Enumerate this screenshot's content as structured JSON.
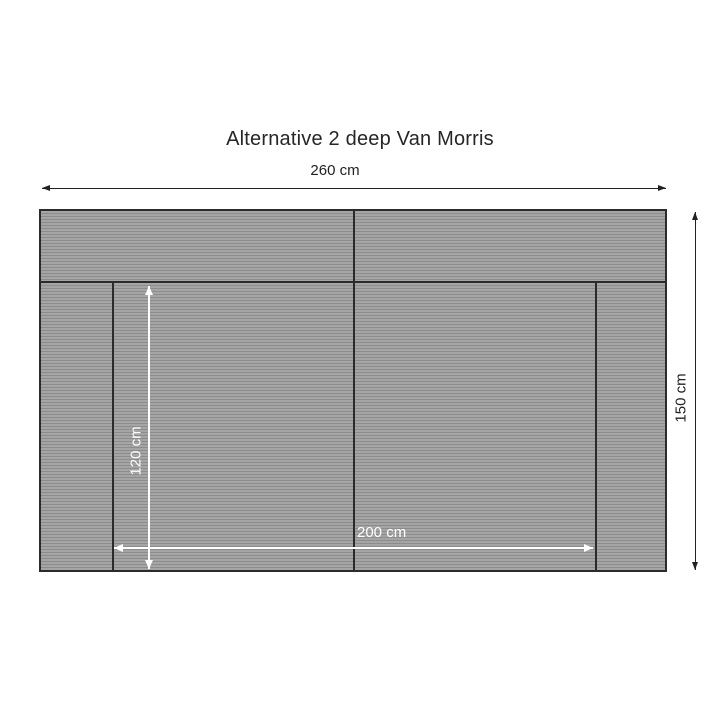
{
  "colors": {
    "background": "#ffffff",
    "fabric-light": "#a5a5a5",
    "fabric-dark": "#8c8c8c",
    "outline": "#2b2b2b",
    "dim-dark": "#222222",
    "dim-light": "#ffffff",
    "title-text": "#262626"
  },
  "diagram": {
    "title": "Alternative 2 deep Van Morris",
    "labels": {
      "overall_width": "260 cm",
      "overall_depth": "150 cm",
      "seat_depth": "120 cm",
      "seat_width": "200 cm"
    }
  }
}
